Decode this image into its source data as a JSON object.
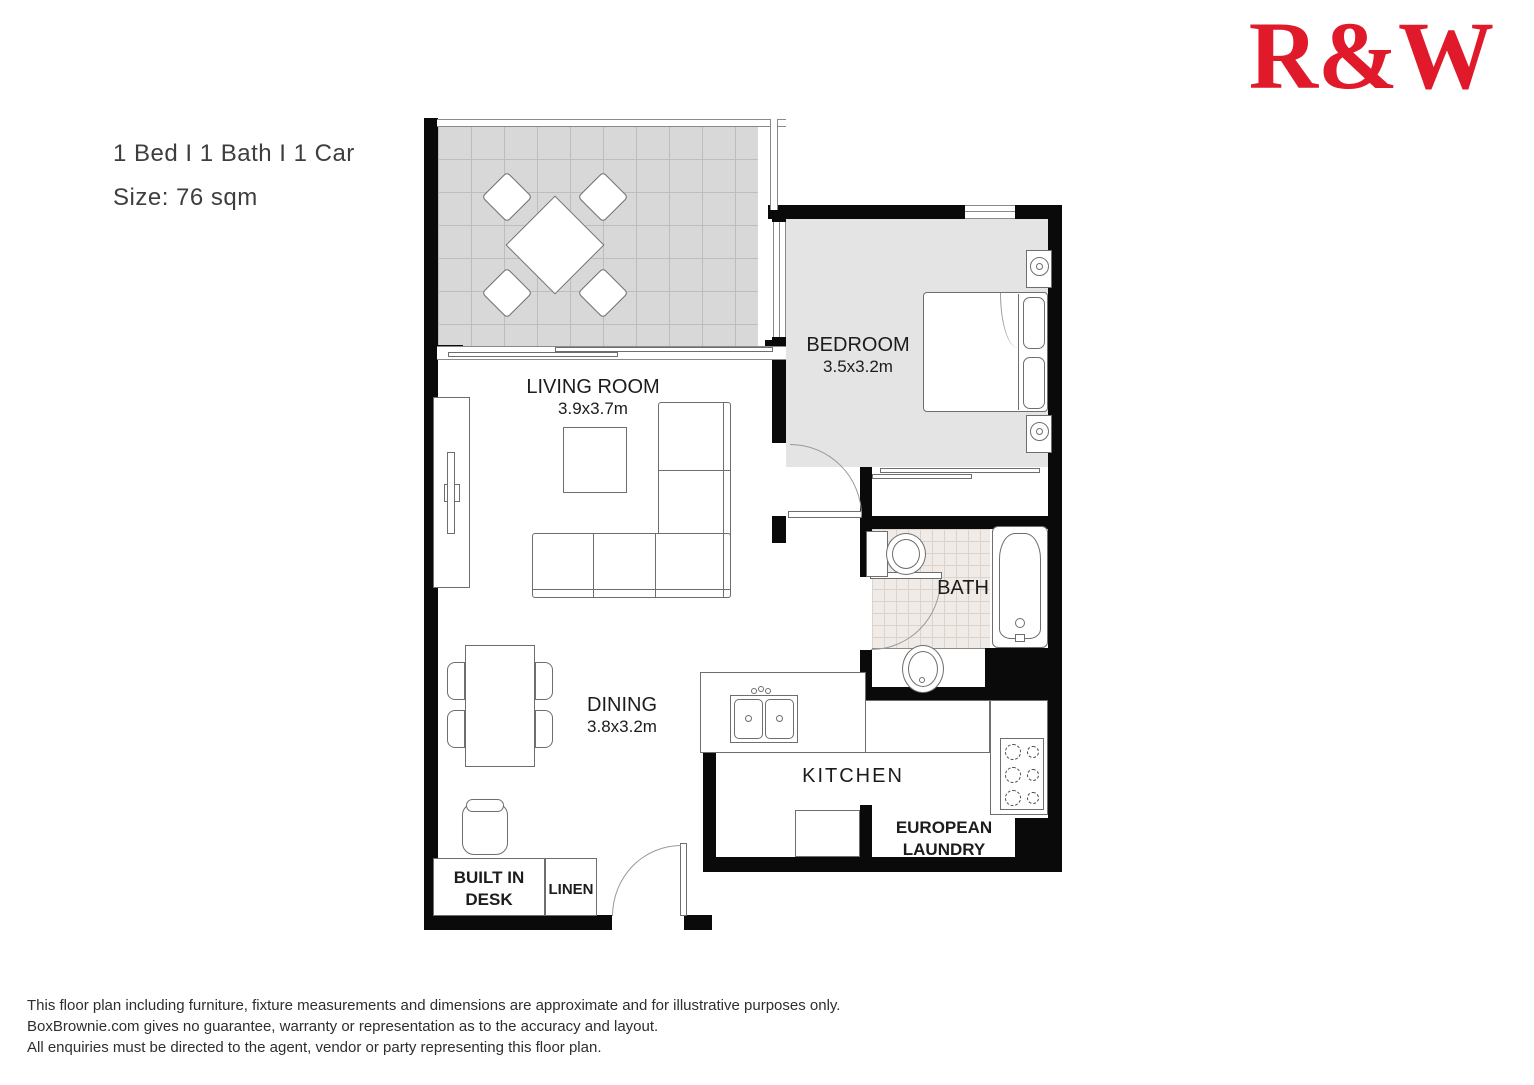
{
  "header": {
    "specs": "1 Bed I 1 Bath I 1 Car",
    "size": "Size: 76 sqm"
  },
  "logo": {
    "text": "R&W"
  },
  "colors": {
    "logo_red": "#e11a2b",
    "wall": "#0a0a0a",
    "text": "#1c1c1c",
    "header_text": "#3e3e3e",
    "disclaimer_text": "#2e2e2e",
    "balcony_tile": "#d8d8d8",
    "balcony_grid": "#bdbdbd",
    "bedroom_floor": "#e4e4e4",
    "bath_tile": "#f0ebe7",
    "bath_grid": "#dcd3cc",
    "line": "#6e6e6e"
  },
  "rooms": {
    "living": {
      "name": "LIVING ROOM",
      "dims": "3.9x3.7m"
    },
    "bedroom": {
      "name": "BEDROOM",
      "dims": "3.5x3.2m"
    },
    "dining": {
      "name": "DINING",
      "dims": "3.8x3.2m"
    },
    "bath": {
      "name": "BATH"
    },
    "kitchen": {
      "name": "KITCHEN"
    },
    "laundry": {
      "name_line1": "EUROPEAN",
      "name_line2": "LAUNDRY"
    },
    "built_in_desk": {
      "name_line1": "BUILT IN",
      "name_line2": "DESK"
    },
    "linen": {
      "name": "LINEN"
    }
  },
  "disclaimer": {
    "line1": "This floor plan including furniture, fixture measurements and dimensions are approximate and for illustrative purposes only.",
    "line2": "BoxBrownie.com gives no guarantee, warranty or representation as to the accuracy and layout.",
    "line3": "All enquiries must be directed to the agent, vendor or party representing this floor plan."
  }
}
